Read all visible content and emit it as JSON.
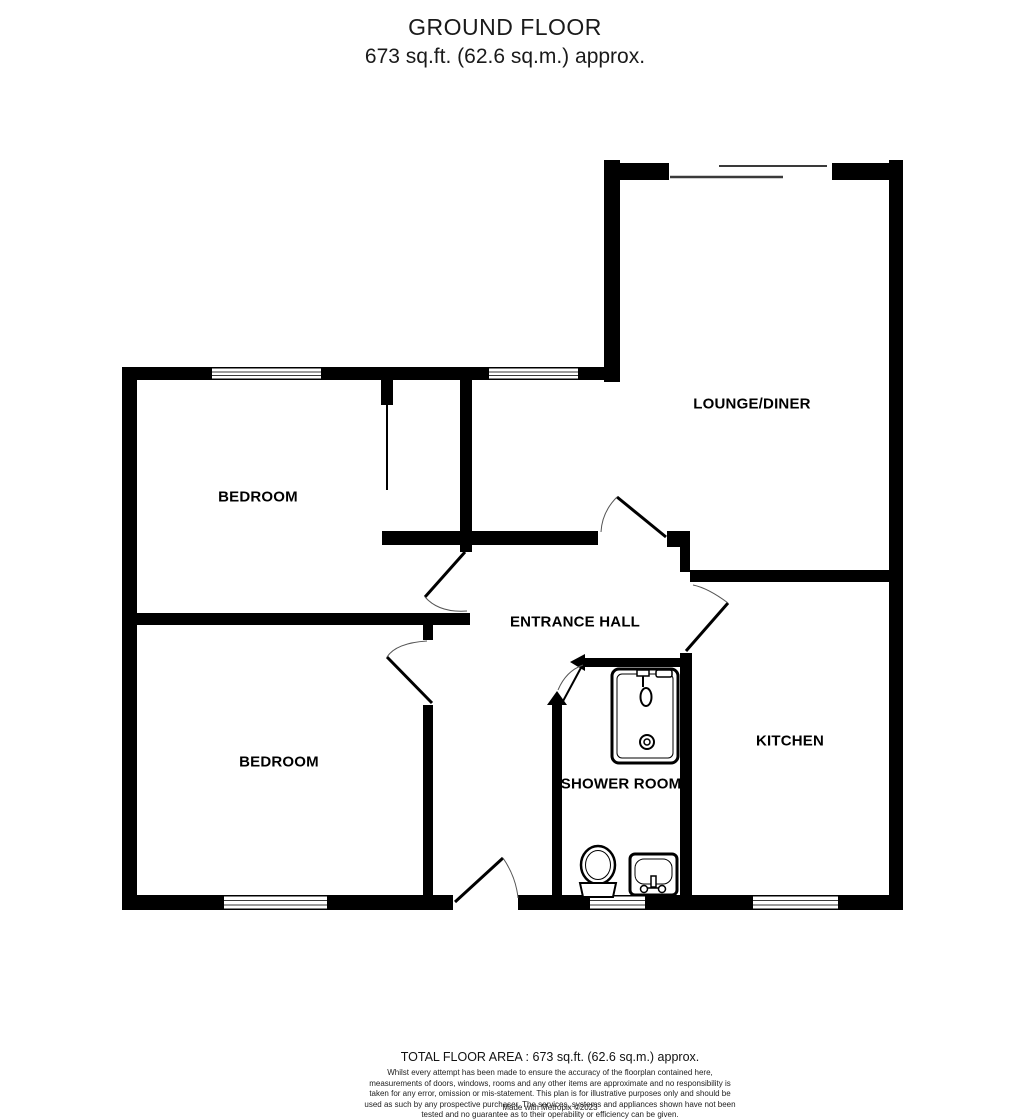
{
  "header": {
    "title": "GROUND FLOOR",
    "subtitle": "673 sq.ft. (62.6 sq.m.) approx."
  },
  "rooms": {
    "lounge": "LOUNGE/DINER",
    "bedroom_top": "BEDROOM",
    "entrance_hall": "ENTRANCE HALL",
    "bedroom_bottom": "BEDROOM",
    "shower_room": "SHOWER ROOM",
    "kitchen": "KITCHEN"
  },
  "footer": {
    "total_area": "TOTAL FLOOR AREA : 673 sq.ft. (62.6 sq.m.) approx.",
    "disclaimer": "Whilst every attempt has been made to ensure the accuracy of the floorplan contained here, measurements of doors, windows, rooms and any other items are approximate and no responsibility is taken for any error, omission or mis-statement. This plan is for illustrative purposes only and should be used as such by any prospective purchaser. The services, systems and appliances shown have not been tested and no guarantee as to their operability or efficiency can be given.",
    "credit": "Made with Metropix ©2023"
  },
  "colors": {
    "wall": "#000000",
    "background": "#ffffff",
    "window_line": "#3a3a3a"
  }
}
